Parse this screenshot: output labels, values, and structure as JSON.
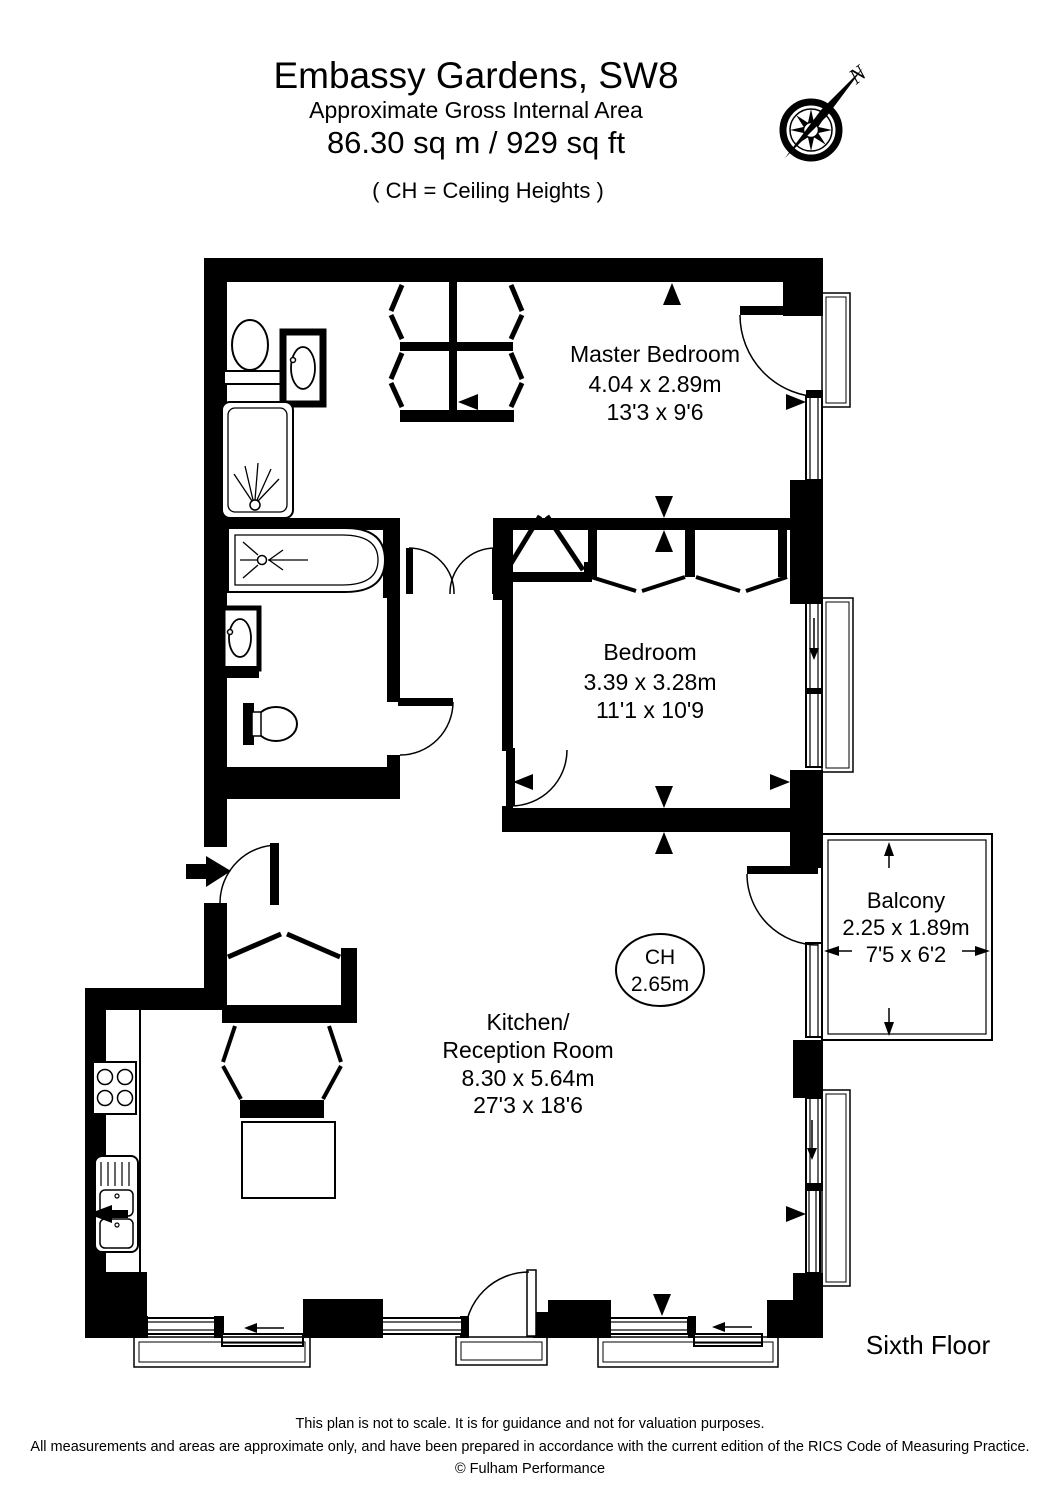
{
  "header": {
    "title": "Embassy Gardens, SW8",
    "subtitle": "Approximate Gross Internal Area",
    "area": "86.30 sq m  /  929 sq ft",
    "note": "( CH = Ceiling Heights )"
  },
  "compass": {
    "north_label": "N"
  },
  "rooms": {
    "master": {
      "name": "Master Bedroom",
      "dim_m": "4.04 x 2.89m",
      "dim_ft": "13'3 x 9'6"
    },
    "bedroom": {
      "name": "Bedroom",
      "dim_m": "3.39 x 3.28m",
      "dim_ft": "11'1 x 10'9"
    },
    "balcony": {
      "name": "Balcony",
      "dim_m": "2.25 x 1.89m",
      "dim_ft": "7'5 x 6'2"
    },
    "kitchen": {
      "name_line1": "Kitchen/",
      "name_line2": "Reception Room",
      "dim_m": "8.30 x 5.64m",
      "dim_ft": "27'3 x 18'6"
    }
  },
  "ceiling_height": {
    "label": "CH",
    "value": "2.65m"
  },
  "floor_label": "Sixth Floor",
  "footer": {
    "line1": "This plan is not to scale. It is for guidance and not for valuation purposes.",
    "line2": "All measurements and areas are approximate only, and have been prepared in accordance with the current edition of the RICS Code of Measuring Practice.",
    "line3": "© Fulham Performance"
  },
  "colors": {
    "wall": "#000000",
    "text": "#000000",
    "background": "#ffffff"
  }
}
